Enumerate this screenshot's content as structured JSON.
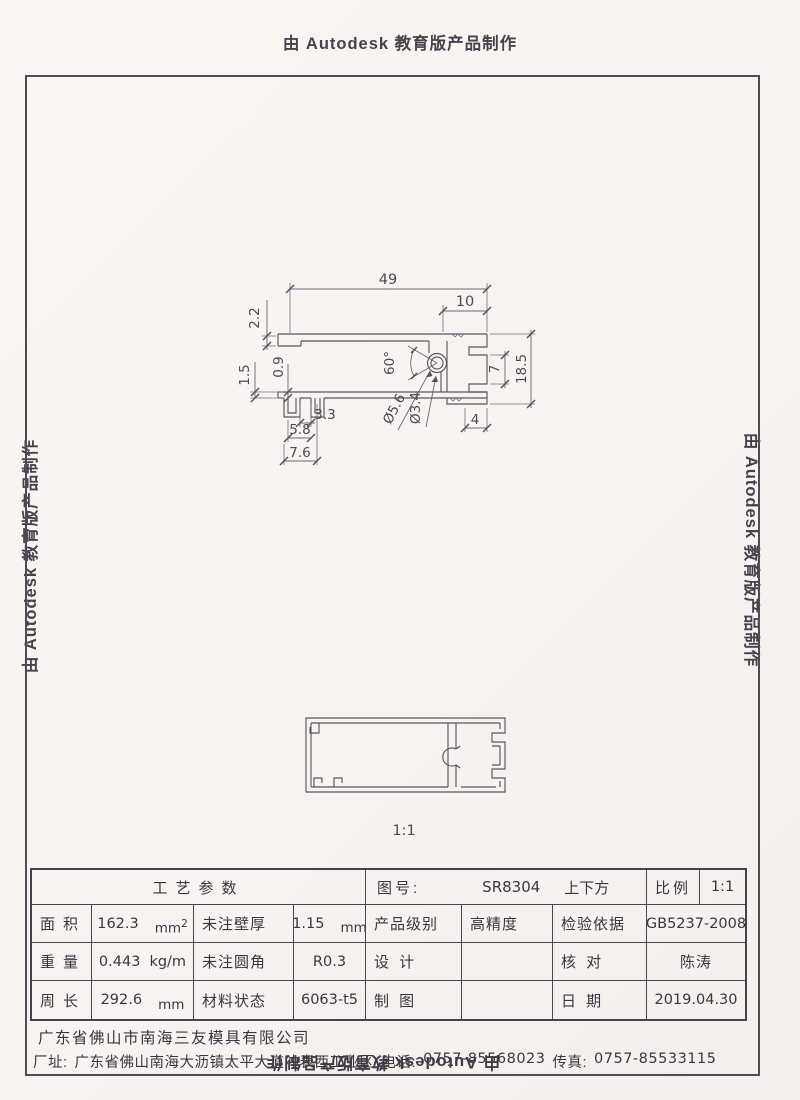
{
  "watermarks": {
    "top": "由 Autodesk 教育版产品制作",
    "left": "由 Autodesk 教育版产品制作",
    "right": "由 Autodesk 教育版产品制作",
    "bottom": "由 Autodesk 教育版产品制作"
  },
  "drawing": {
    "scale_caption": "1:1",
    "dimensions": {
      "overall_width": "49",
      "channel_width": "10",
      "top_wall": "2.2",
      "hook_wall": "0.9",
      "bottom_wall": "1.5",
      "hook_gap": "3.3",
      "hook_inner": "5.8",
      "hook_outer": "7.6",
      "boss_angle": "60°",
      "boss_outer_dia": "Ø5.6",
      "boss_inner_dia": "Ø3.4",
      "slot_height": "7",
      "overall_height": "18.5",
      "leg_width": "4"
    }
  },
  "title_block": {
    "process_header": "工艺参数",
    "drawing_no_label": "图号:",
    "drawing_no_value": "SR8304",
    "drawing_name": "上下方",
    "scale_label": "比例",
    "scale_value": "1:1",
    "area_label": "面积",
    "area_value": "162.3",
    "area_unit": "mm",
    "area_exp": "2",
    "wall_label": "未注壁厚",
    "wall_value": "1.15",
    "wall_unit": "mm",
    "grade_label": "产品级别",
    "grade_value": "高精度",
    "standard_label": "检验依据",
    "standard_value": "GB5237-2008",
    "weight_label": "重量",
    "weight_value": "0.443",
    "weight_unit": "kg/m",
    "fillet_label": "未注圆角",
    "fillet_value": "R0.3",
    "design_label": "设 计",
    "design_value": "",
    "check_label": "核 对",
    "check_value": "陈涛",
    "perimeter_label": "周长",
    "perimeter_value": "292.6",
    "perimeter_unit": "mm",
    "material_label": "材料状态",
    "material_value": "6063-t5",
    "draft_label": "制 图",
    "draft_value": "",
    "date_label": "日 期",
    "date_value": "2019.04.30"
  },
  "footer": {
    "company": "广东省佛山市南海三友模具有限公司",
    "address_label": "厂址:",
    "address": "广东省佛山南海大沥镇太平大道冲表西工业区",
    "phone_label": "电话:",
    "phone": "0757-85568023",
    "fax_label": "传真:",
    "fax": "0757-85533115"
  }
}
